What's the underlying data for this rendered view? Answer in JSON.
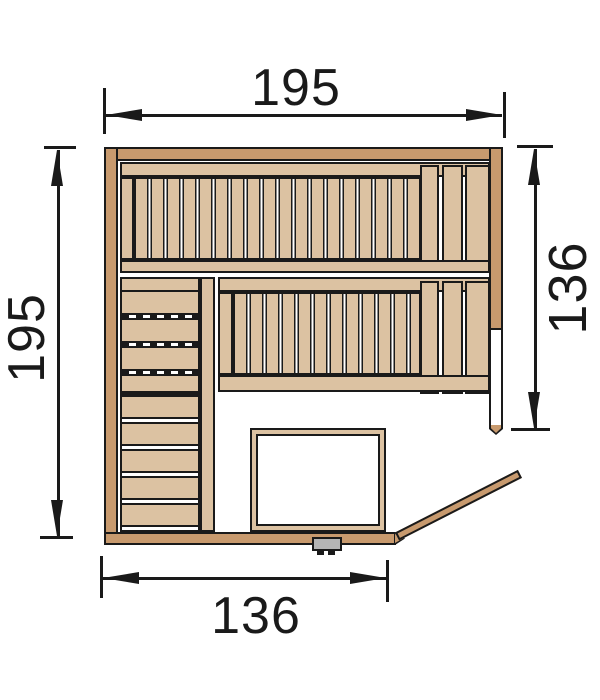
{
  "diagram": {
    "type": "floor-plan",
    "subject": "corner sauna top view",
    "dimensions": {
      "top_width": "195",
      "left_height": "195",
      "right_height": "136",
      "bottom_width": "136"
    }
  },
  "colors": {
    "wall_wood": "#c89a6e",
    "bench_wood": "#dcc2a2",
    "outline": "#1a1a1a",
    "handle_gray": "#b5b5b5",
    "background": "#ffffff"
  }
}
